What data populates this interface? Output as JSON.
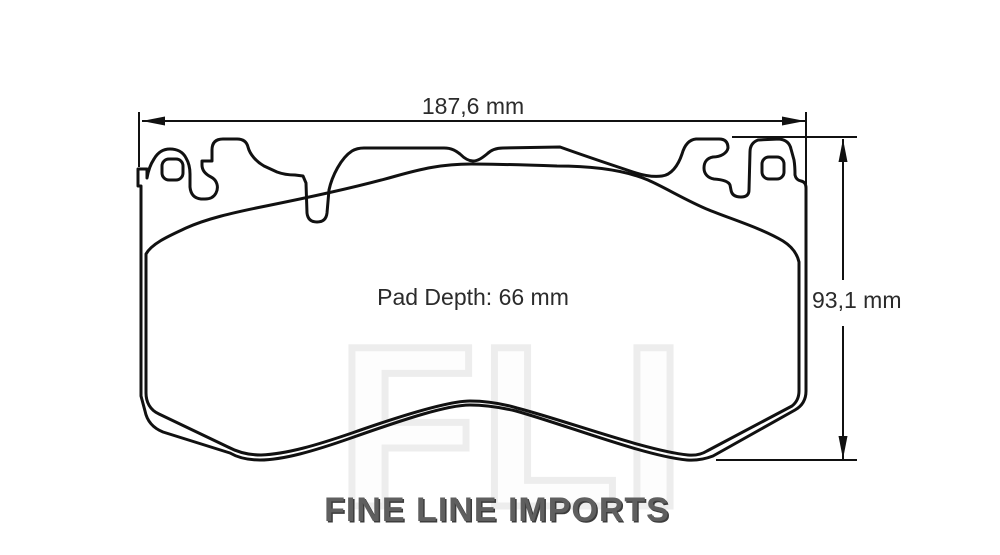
{
  "drawing": {
    "width_dimension": "187,6 mm",
    "height_dimension": "93,1 mm",
    "pad_depth": "Pad Depth: 66 mm"
  },
  "watermark_text": "FLI",
  "footer_brand": "FINE LINE IMPORTS",
  "colors": {
    "line": "#111111",
    "dim_line": "#111111",
    "label_text": "#2b2b2b",
    "brand_text": "#5f5f5f",
    "brand_shadow": "#3c3c3c",
    "watermark": "#ededed",
    "background": "#ffffff"
  }
}
